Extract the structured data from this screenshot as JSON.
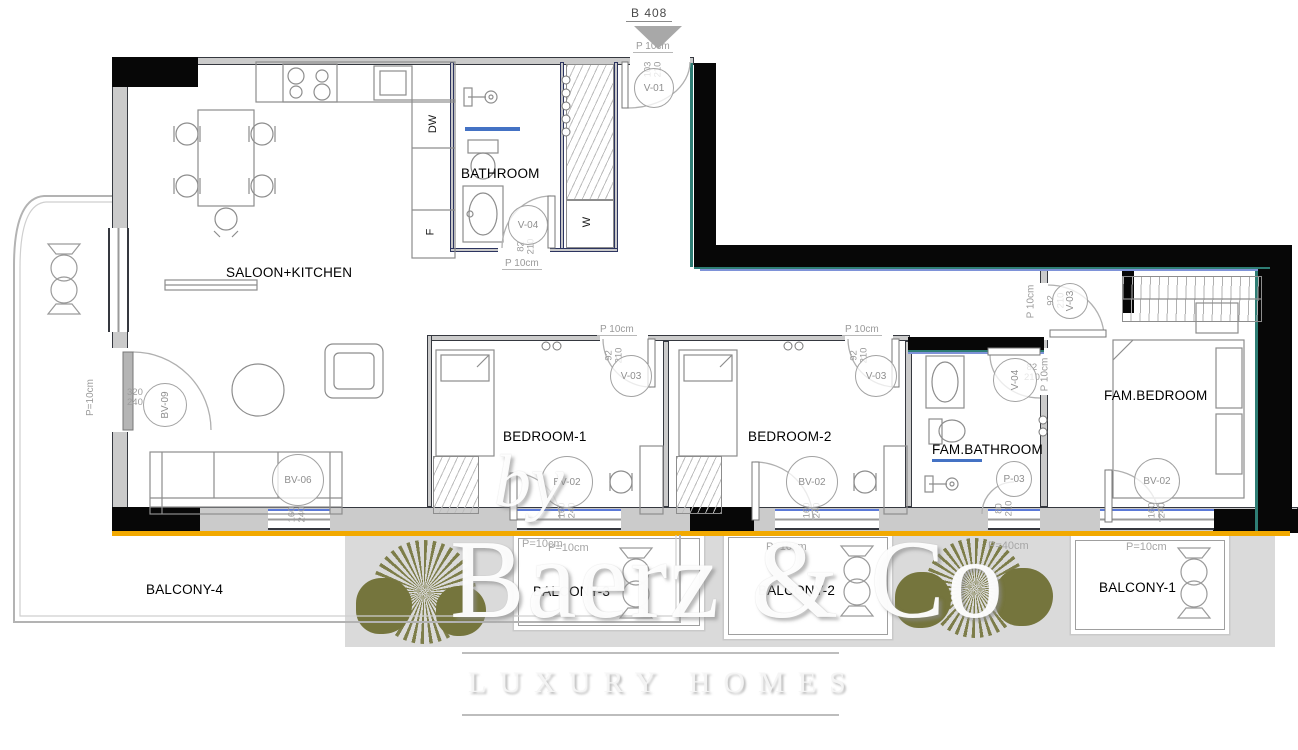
{
  "marker": {
    "label": "B 408"
  },
  "rooms": {
    "saloon": "SALOON+KITCHEN",
    "bathroom": "BATHROOM",
    "bedroom1": "BEDROOM-1",
    "bedroom2": "BEDROOM-2",
    "fam_bathroom": "FAM.BATHROOM",
    "fam_bedroom": "FAM.BEDROOM",
    "balcony1": "BALCONY-1",
    "balcony2": "BALCONY-2",
    "balcony3": "BALCONY-3",
    "balcony4": "BALCONY-4"
  },
  "appliances": {
    "dishwasher": "DW",
    "fridge": "F",
    "wardrobe": "W"
  },
  "notes": {
    "door_width": "P 10cm",
    "parapet10": "P=10cm",
    "parapet40": "P=40cm"
  },
  "tags": {
    "v01": {
      "code": "V-01",
      "w": "103",
      "h": "210"
    },
    "v04_bath": {
      "code": "V-04",
      "w": "82",
      "h": "210"
    },
    "v03_bed1": {
      "code": "V-03",
      "w": "92",
      "h": "210"
    },
    "v03_bed2": {
      "code": "V-03",
      "w": "92",
      "h": "210"
    },
    "v03_fam": {
      "code": "V-03",
      "w": "92",
      "h": "210"
    },
    "v04_fam": {
      "code": "V-04",
      "w": "82",
      "h": "210"
    },
    "p03": {
      "code": "P-03",
      "w": "80",
      "h": "210"
    },
    "bv09": {
      "code": "BV-09",
      "w": "320",
      "h": "240"
    },
    "bv06": {
      "code": "BV-06",
      "w": "160",
      "h": "240"
    },
    "bv02_bed1": {
      "code": "BV-02",
      "w": "160",
      "h": "240"
    },
    "bv02_bed2": {
      "code": "BV-02",
      "w": "160",
      "h": "240"
    },
    "bv02_fam": {
      "code": "BV-02",
      "w": "160",
      "h": "240"
    }
  },
  "watermark": {
    "by": "by",
    "brand": "Baerz & Co",
    "tagline": "LUXURY HOMES"
  },
  "colors": {
    "orange": "#F2A900",
    "teal": "#2E7D74",
    "blue": "#4472C4",
    "olive": "#75753D"
  }
}
